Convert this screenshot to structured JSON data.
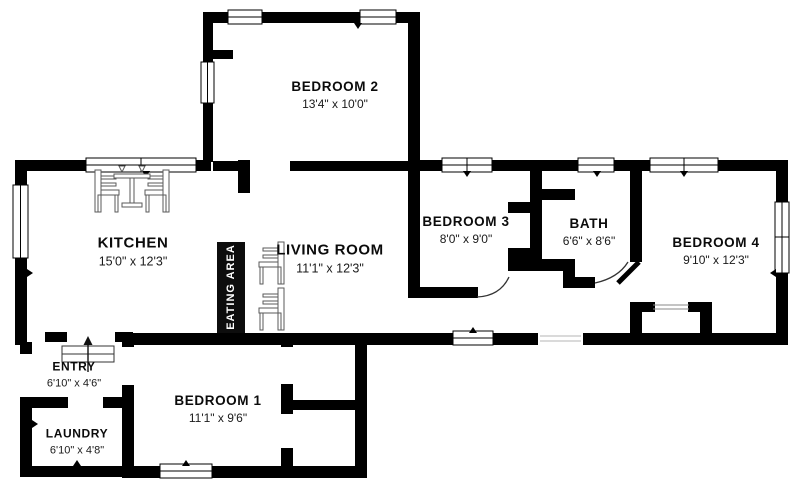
{
  "title": "Residential floor plan",
  "eating_area": {
    "label": "EATING AREA"
  },
  "rooms": [
    {
      "name": "BEDROOM 2",
      "dims": "13'4\" x 10'0\""
    },
    {
      "name": "KITCHEN",
      "dims": "15'0\" x 12'3\""
    },
    {
      "name": "LIVING ROOM",
      "dims": "11'1\" x 12'3\""
    },
    {
      "name": "BEDROOM 3",
      "dims": "8'0\" x 9'0\""
    },
    {
      "name": "BATH",
      "dims": "6'6\" x 8'6\""
    },
    {
      "name": "BEDROOM 4",
      "dims": "9'10\" x 12'3\""
    },
    {
      "name": "ENTRY",
      "dims": "6'10\" x 4'6\""
    },
    {
      "name": "BEDROOM 1",
      "dims": "11'1\" x 9'6\""
    },
    {
      "name": "LAUNDRY",
      "dims": "6'10\" x 4'8\""
    }
  ],
  "colors": {
    "wall": "#000000",
    "background": "#ffffff",
    "eating_area_bg": "#0d0d0d",
    "eating_area_text": "#ffffff",
    "furniture_stroke": "#5a5a5a"
  }
}
